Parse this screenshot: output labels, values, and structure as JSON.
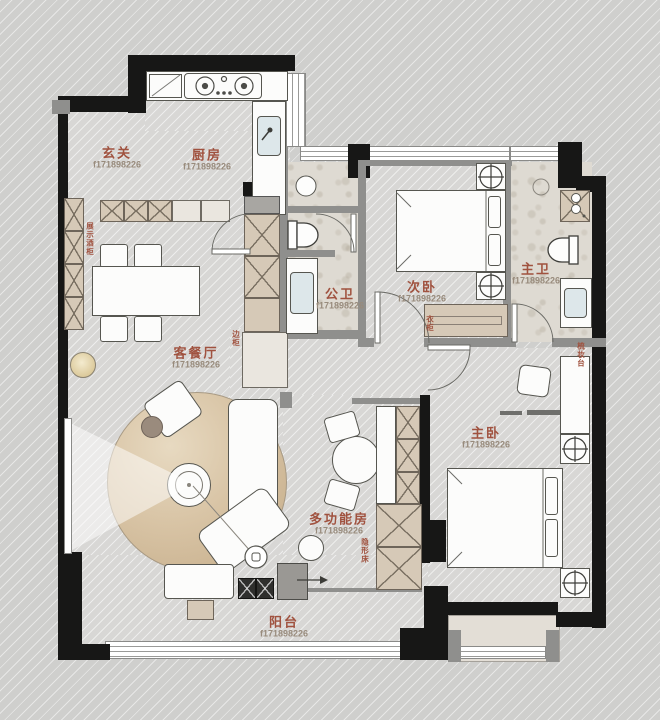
{
  "floorplan": {
    "watermark": "f171898226",
    "colors": {
      "label": "#a0523f",
      "watermark": "#988b7c",
      "wall": "#171716",
      "cabinet": "#d6c9b7"
    },
    "rooms": [
      {
        "id": "entry",
        "label": "玄关"
      },
      {
        "id": "kitchen",
        "label": "厨房"
      },
      {
        "id": "public-bathroom",
        "label": "公卫"
      },
      {
        "id": "second-bedroom",
        "label": "次卧"
      },
      {
        "id": "master-bathroom",
        "label": "主卫"
      },
      {
        "id": "living-dining-room",
        "label": "客餐厅"
      },
      {
        "id": "master-bedroom",
        "label": "主卧"
      },
      {
        "id": "multifunction-room",
        "label": "多功能房"
      },
      {
        "id": "balcony",
        "label": "阳台"
      }
    ],
    "annotations": [
      {
        "id": "display-wine-cabinet",
        "label": "展示酒柜"
      },
      {
        "id": "side-cabinet",
        "label": "边柜"
      },
      {
        "id": "wardrobe",
        "label": "衣柜"
      },
      {
        "id": "dressing-table",
        "label": "梳妆台"
      },
      {
        "id": "hidden-bed",
        "label": "隐形床"
      }
    ]
  }
}
